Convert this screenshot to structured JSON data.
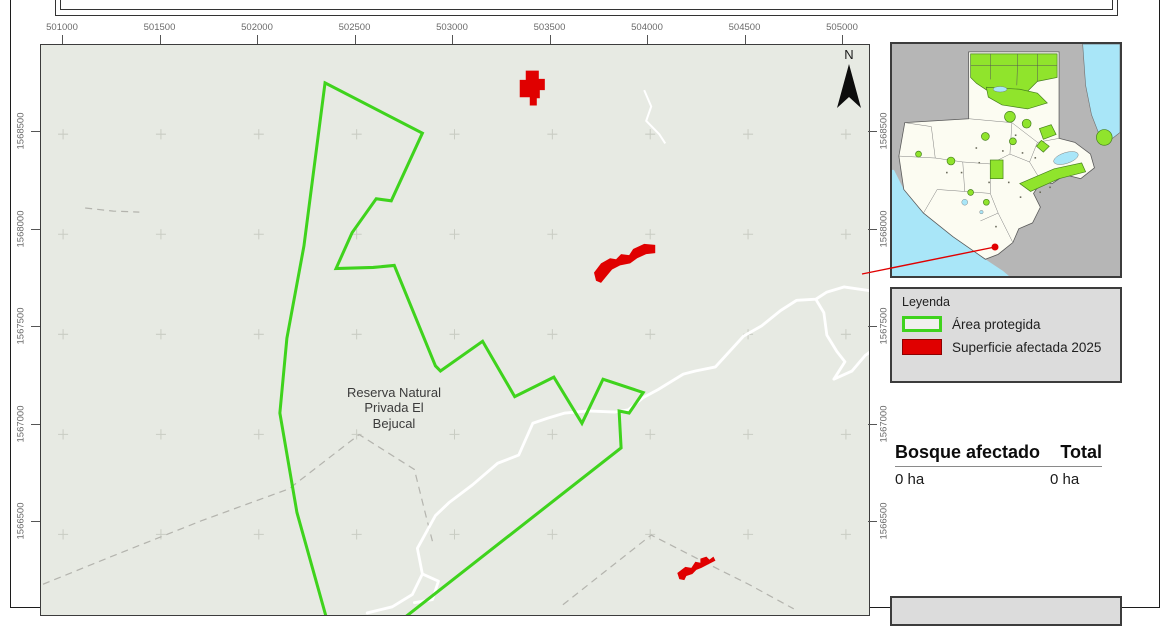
{
  "map": {
    "x_axis_labels": [
      "501000",
      "501500",
      "502000",
      "502500",
      "503000",
      "503500",
      "504000",
      "504500",
      "505000"
    ],
    "y_axis_labels": [
      "1568500",
      "1568000",
      "1567500",
      "1567000",
      "1566500"
    ],
    "area_label_lines": [
      "Reserva Natural",
      "Privada El",
      "Bejucal"
    ],
    "north_label": "N"
  },
  "legend": {
    "title": "Leyenda",
    "items": [
      {
        "label": "Área protegida",
        "swatch": "green-outline"
      },
      {
        "label": "Superficie afectada 2025",
        "swatch": "red-fill"
      }
    ]
  },
  "stats_table": {
    "columns": [
      "Bosque afectado",
      "Total"
    ],
    "values": [
      "0 ha",
      "0 ha"
    ]
  },
  "colors": {
    "protected": "#3fd31d",
    "affected": "#e00000",
    "map_bg": "#e7eae3",
    "panel_bg": "#dcdcdc",
    "frame": "#3c3c3c",
    "axis_text": "#6a6a6a",
    "grid": "#c9ccc3",
    "road": "#ffffff",
    "boundary_dashed": "#b4b4ae",
    "inset_land": "#fcfcf2",
    "inset_water": "#a9e6f8",
    "inset_neighbor": "#b6b6b6",
    "inset_protected": "#90e42c"
  }
}
